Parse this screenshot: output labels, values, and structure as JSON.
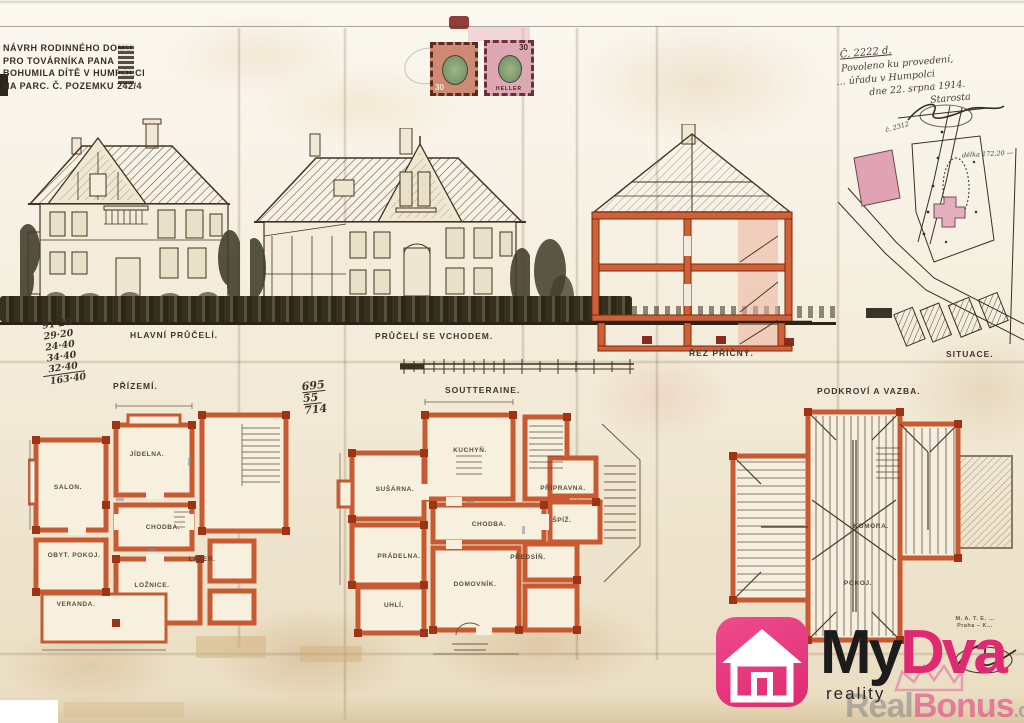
{
  "title_block": {
    "lines": [
      "NÁVRH RODINNÉHO DOMU",
      "PRO TOVÁRNÍKA PANA",
      "BOHUMILA DÍTĚ V HUMPOLCI",
      "NA PARC. Č. POZEMKU 242/4"
    ]
  },
  "stamps": {
    "left": {
      "value": "30",
      "unit": "HELLER"
    },
    "right": {
      "value": "30",
      "unit": "HELLER"
    }
  },
  "approval_note": {
    "lines": [
      "Č. 2222 d.",
      "Povoleno ku provedení,",
      "… úřadu v Humpolci",
      "dne 22. srpna 1914.",
      "Starosta"
    ]
  },
  "calculations": {
    "left_column": [
      "91·20",
      "29·20",
      "24·40",
      "34·40",
      "32·40",
      "163·40"
    ],
    "middle_column": [
      "695",
      "55",
      "714"
    ]
  },
  "drawings": {
    "main_facade": {
      "label": "HLAVNÍ PRŮČELÍ."
    },
    "entrance_facade": {
      "label": "PRŮČELÍ SE VCHODEM."
    },
    "cross_section": {
      "label": "ŘEZ PŘÍČNÝ."
    },
    "site_plan": {
      "label": "SITUACE.",
      "annotations": [
        "č. 2312",
        "délka 172,20 —"
      ]
    },
    "ground_floor": {
      "label": "PŘÍZEMÍ.",
      "rooms": [
        "SALON.",
        "JÍDELNA.",
        "CHODBA.",
        "OBYT. POKOJ.",
        "LOŽNICE.",
        "VERANDA.",
        "LÁZEŇ."
      ]
    },
    "basement": {
      "label": "SOUTTERAINE.",
      "rooms": [
        "KUCHYŇ.",
        "SUŠÁRNA.",
        "PRÁDELNA.",
        "UHLÍ.",
        "DOMOVNÍK.",
        "CHODBA.",
        "ŠPÍŽ.",
        "PŘEDSÍŇ.",
        "PŘÍPRAVNA."
      ]
    },
    "attic": {
      "label": "PODKROVÍ A VAZBA.",
      "rooms": [
        "KOMORA.",
        "POKOJ."
      ]
    }
  },
  "builder_stamp": {
    "lines": [
      "M. A. T. E. …",
      "Praha – K…"
    ]
  },
  "branding": {
    "logo": {
      "prefix": "My",
      "suffix": "Dva",
      "tagline": "reality"
    },
    "watermark": {
      "part1": "Real",
      "part2": "Bonus",
      "suffix": ".cz"
    }
  },
  "colors": {
    "paper": "#f2ead9",
    "ink": "#42342a",
    "wall_orange": "#d2663a",
    "wall_red": "#993113",
    "site_pink": "#dfa3b5",
    "logo_pink": "#df2a71",
    "stamp_green": "#7d9a6d"
  }
}
